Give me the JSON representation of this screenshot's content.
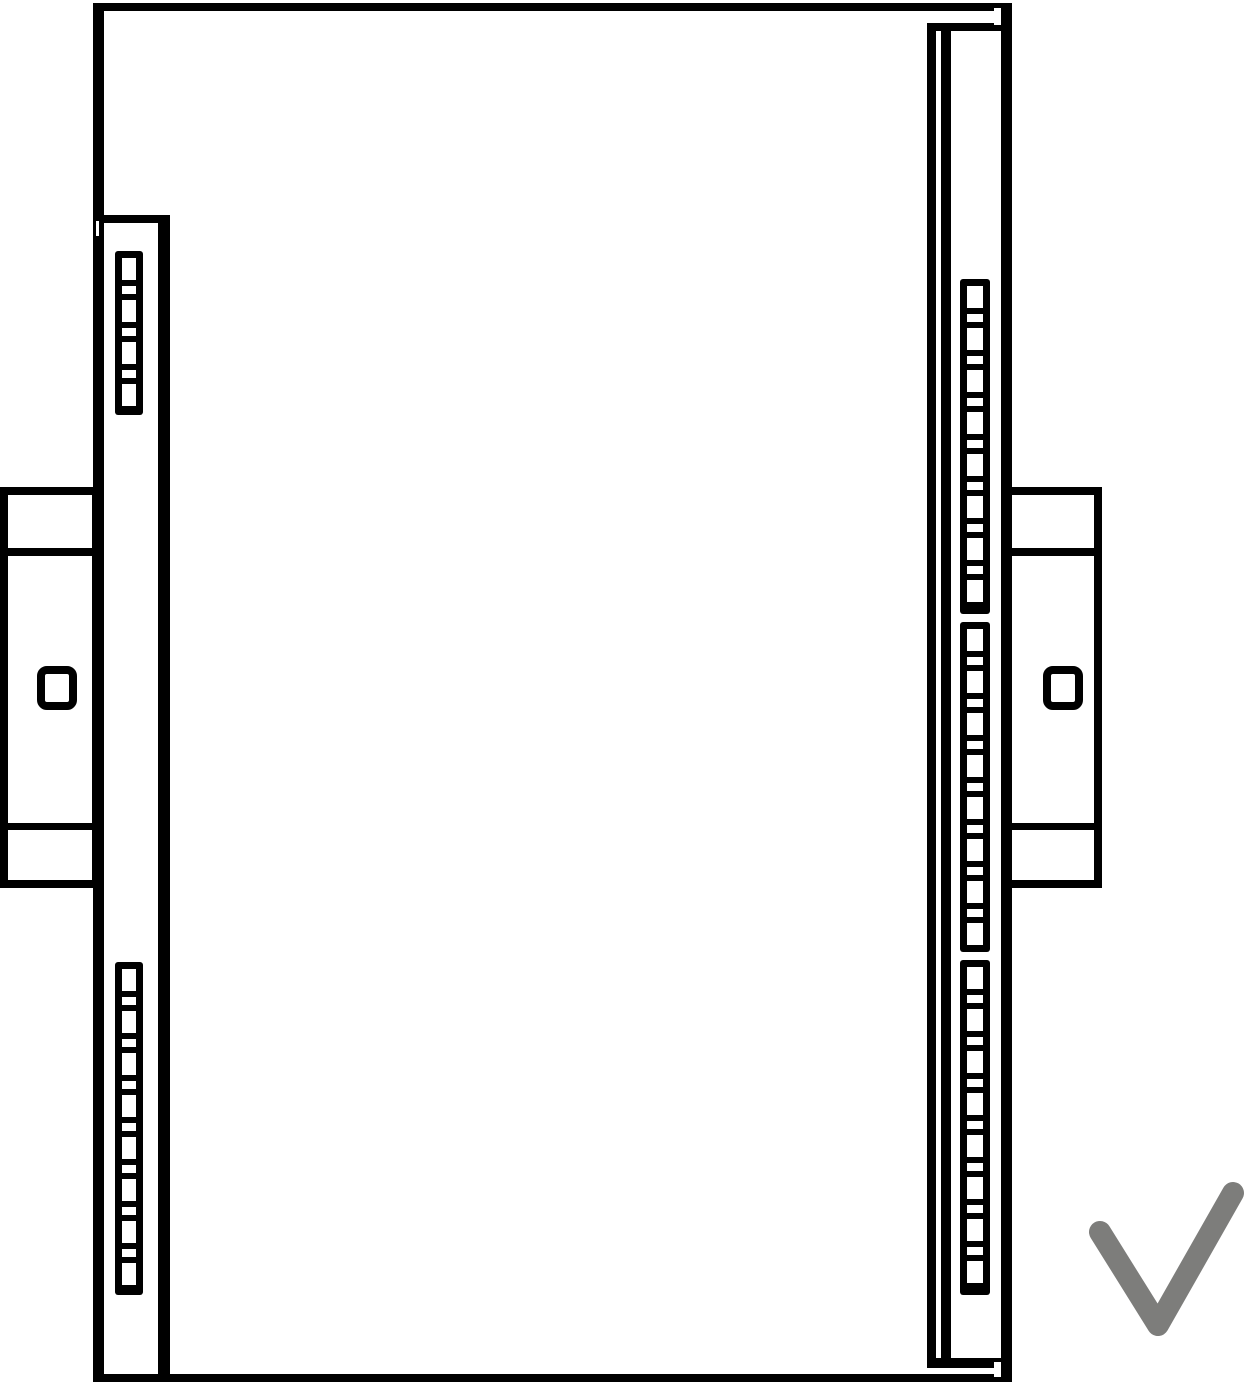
{
  "page": {
    "background": "#ffffff",
    "stroke_color": "#000000",
    "description": "Technical line drawing: side view of a DIN-rail mounted device with slotted vent strips, two rail mounting brackets with square holes, and a gray check mark indicating correct mounting orientation"
  },
  "drawing": {
    "ladders": [
      {
        "id": "left-top",
        "x": 115,
        "y": 251,
        "w": 28,
        "h": 164,
        "cells": 7,
        "tall": 22,
        "short": 8,
        "gap": 6,
        "pad": 7
      },
      {
        "id": "left-bottom",
        "x": 115,
        "y": 962,
        "w": 28,
        "h": 333,
        "cells": 15,
        "tall": 22,
        "short": 8,
        "gap": 6,
        "pad": 7
      },
      {
        "id": "right-top",
        "x": 960,
        "y": 279,
        "w": 30,
        "h": 335,
        "cells": 15,
        "tall": 22,
        "short": 8,
        "gap": 6,
        "pad": 7
      },
      {
        "id": "right-middle",
        "x": 960,
        "y": 622,
        "w": 30,
        "h": 330,
        "cells": 15,
        "tall": 22,
        "short": 8,
        "gap": 6,
        "pad": 7
      },
      {
        "id": "right-bottom",
        "x": 960,
        "y": 960,
        "w": 30,
        "h": 335,
        "cells": 15,
        "tall": 22,
        "short": 8,
        "gap": 6,
        "pad": 7
      }
    ],
    "checkmark": {
      "points": "1100,1232 1158,1325 1233,1193",
      "color": "#7d7d7b",
      "stroke_width": 22
    }
  }
}
